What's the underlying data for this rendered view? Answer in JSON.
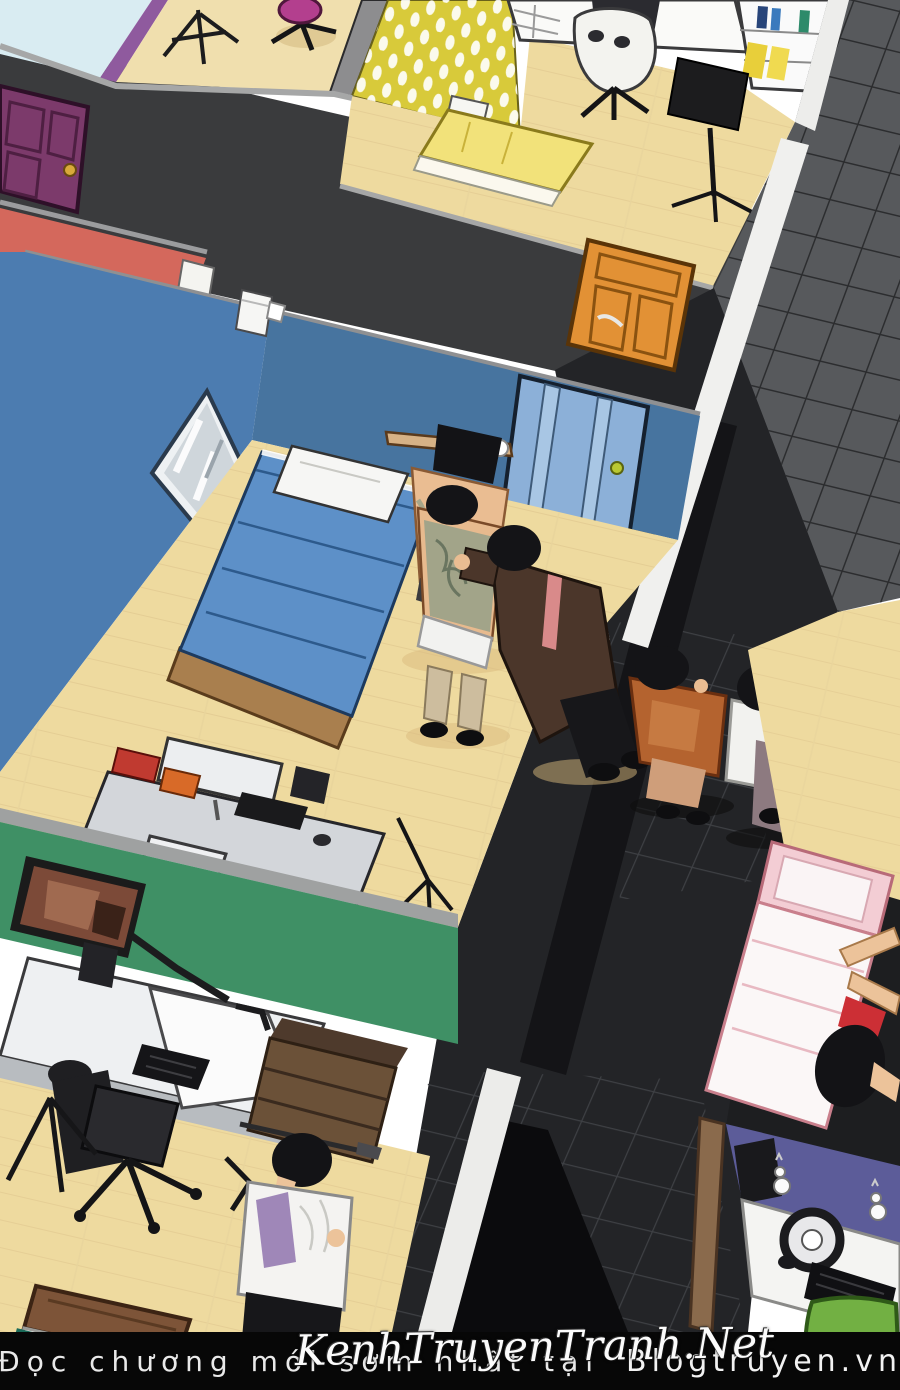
{
  "bottom_bar": {
    "text_left": "Đọc chương mới sớm nhất tại",
    "brand": "Blogtruyen.vn"
  },
  "watermark": {
    "text": "KenhTruyenTranh.Net"
  },
  "palette": {
    "sky": "#d9ecf2",
    "wall_dark": "#3a3b3d",
    "wall_rim": "#a2a3a3",
    "purple_door": "#7c3a6b",
    "orange_door": "#e29135",
    "red_wall": "#d4685c",
    "blue_wall": "#4c7cb0",
    "blue_wall_shade": "#47749f",
    "blue_door": "#8cb0d8",
    "floor_wood": "#eeda9f",
    "bed_blanket": "#5d90c8",
    "green_wall": "#3f9065",
    "yellow_wallpaper": "#d8ca3a",
    "tile_wall": "#57595c",
    "corridor": "#232427",
    "pink_bed": "#f3cdd4",
    "purple_wall": "#5c5c99",
    "chair_green": "#72b043",
    "bar_bg": "#070707",
    "bar_text": "#e9e9e9"
  }
}
